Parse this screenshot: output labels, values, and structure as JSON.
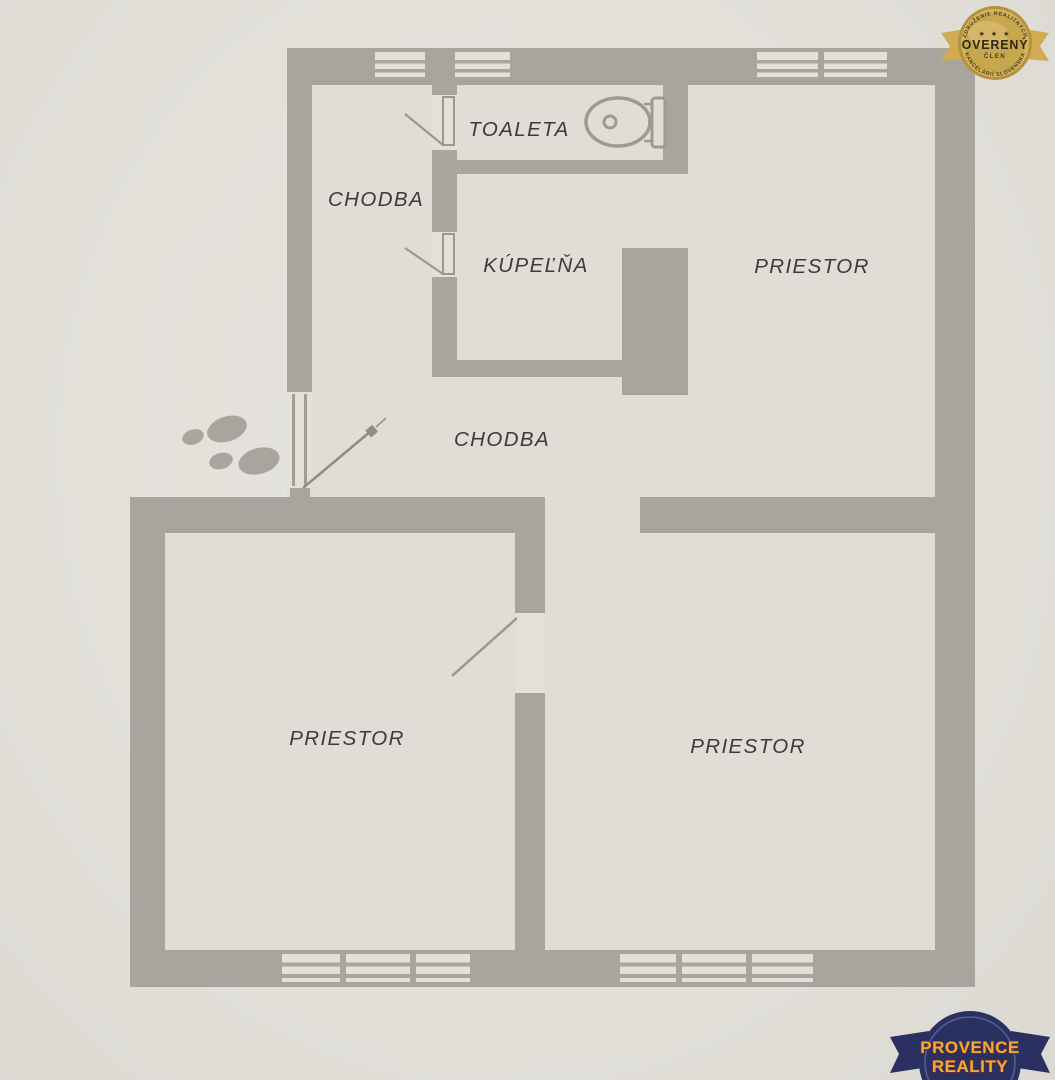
{
  "floor_plan": {
    "rooms": [
      {
        "id": "chodba-top",
        "label": "CHODBA"
      },
      {
        "id": "toaleta",
        "label": "TOALETA"
      },
      {
        "id": "kupelna",
        "label": "KÚPEĽŇA"
      },
      {
        "id": "priestor-top-right",
        "label": "PRIESTOR"
      },
      {
        "id": "chodba-mid",
        "label": "CHODBA"
      },
      {
        "id": "priestor-bottom-left",
        "label": "PRIESTOR"
      },
      {
        "id": "priestor-bottom-right",
        "label": "PRIESTOR"
      }
    ],
    "icons": {
      "toilet": "toilet-icon",
      "footprints": "footprints-icon",
      "entrance_arrow": "entrance-arrow-icon"
    },
    "colors": {
      "paper": "#e4e1db",
      "floor": "#e0ddd7",
      "wall": "#a8a59f",
      "label_text": "#3d3b38"
    }
  },
  "badges": {
    "verified_seal": {
      "arc_top": "ZDRUŽENIE REALITNÝCH",
      "stars": "★ ★ ★",
      "title": "OVERENÝ",
      "subtitle": "ČLEN",
      "arc_bottom": "KANCELÁRIÍ SLOVENSKA",
      "colors": {
        "gold": "#d0ab52",
        "text": "#3a2e12"
      }
    },
    "agency_seal": {
      "line1": "PROVENCE",
      "line2": "REALITY",
      "colors": {
        "navy": "#2a3160",
        "yellow": "#edab38",
        "outline": "#8e2f1f"
      }
    }
  }
}
